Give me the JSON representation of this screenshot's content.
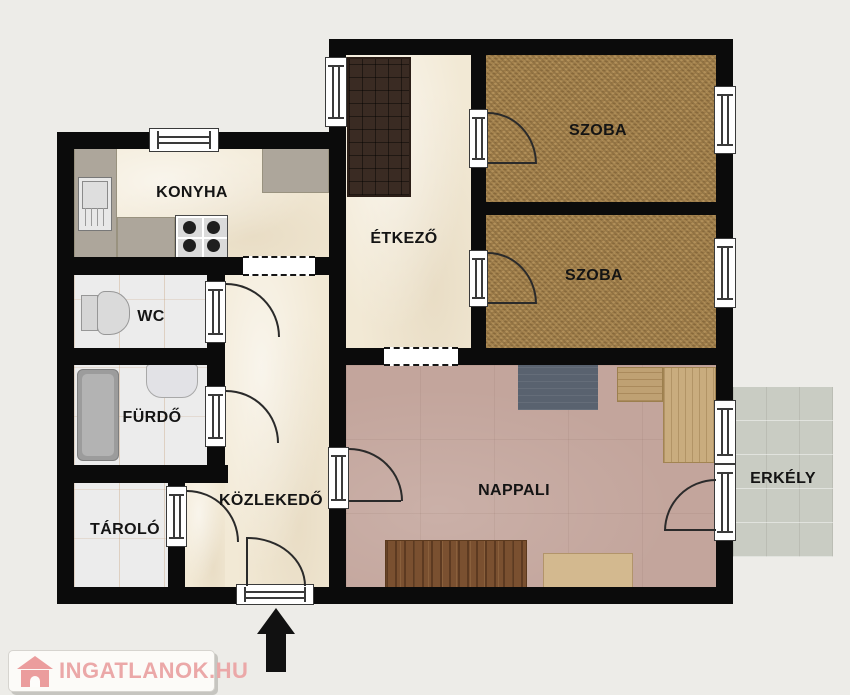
{
  "rooms": {
    "konyha": {
      "label": "KONYHA"
    },
    "wc": {
      "label": "WC"
    },
    "furdo": {
      "label": "FÜRDŐ"
    },
    "tarolo": {
      "label": "TÁROLÓ"
    },
    "kozlekedo": {
      "label": "KÖZLEKEDŐ"
    },
    "etkezo": {
      "label": "ÉTKEZŐ"
    },
    "szoba_1": {
      "label": "SZOBA"
    },
    "szoba_2": {
      "label": "SZOBA"
    },
    "nappali": {
      "label": "NAPPALI"
    },
    "erkely": {
      "label": "ERKÉLY"
    }
  },
  "watermark": {
    "text": "INGATLANOK.HU",
    "icon": "house-icon",
    "text_color": "#eba8a8"
  },
  "entrance": {
    "arrow_direction": "up"
  },
  "colors": {
    "background": "#edece8",
    "wall": "#0b0b0b",
    "floor_cream": "#f2e9d5",
    "floor_tile": "#ececec",
    "floor_carpet": "#a5834e",
    "floor_living": "#c3a59c",
    "floor_balcony": "#c9ccc3",
    "wardrobe_dark": "#3a2b23",
    "counter": "#ada69b",
    "rug": "#59626f",
    "wood_light": "#c9ac7e",
    "wood_dark": "#7a5030"
  }
}
